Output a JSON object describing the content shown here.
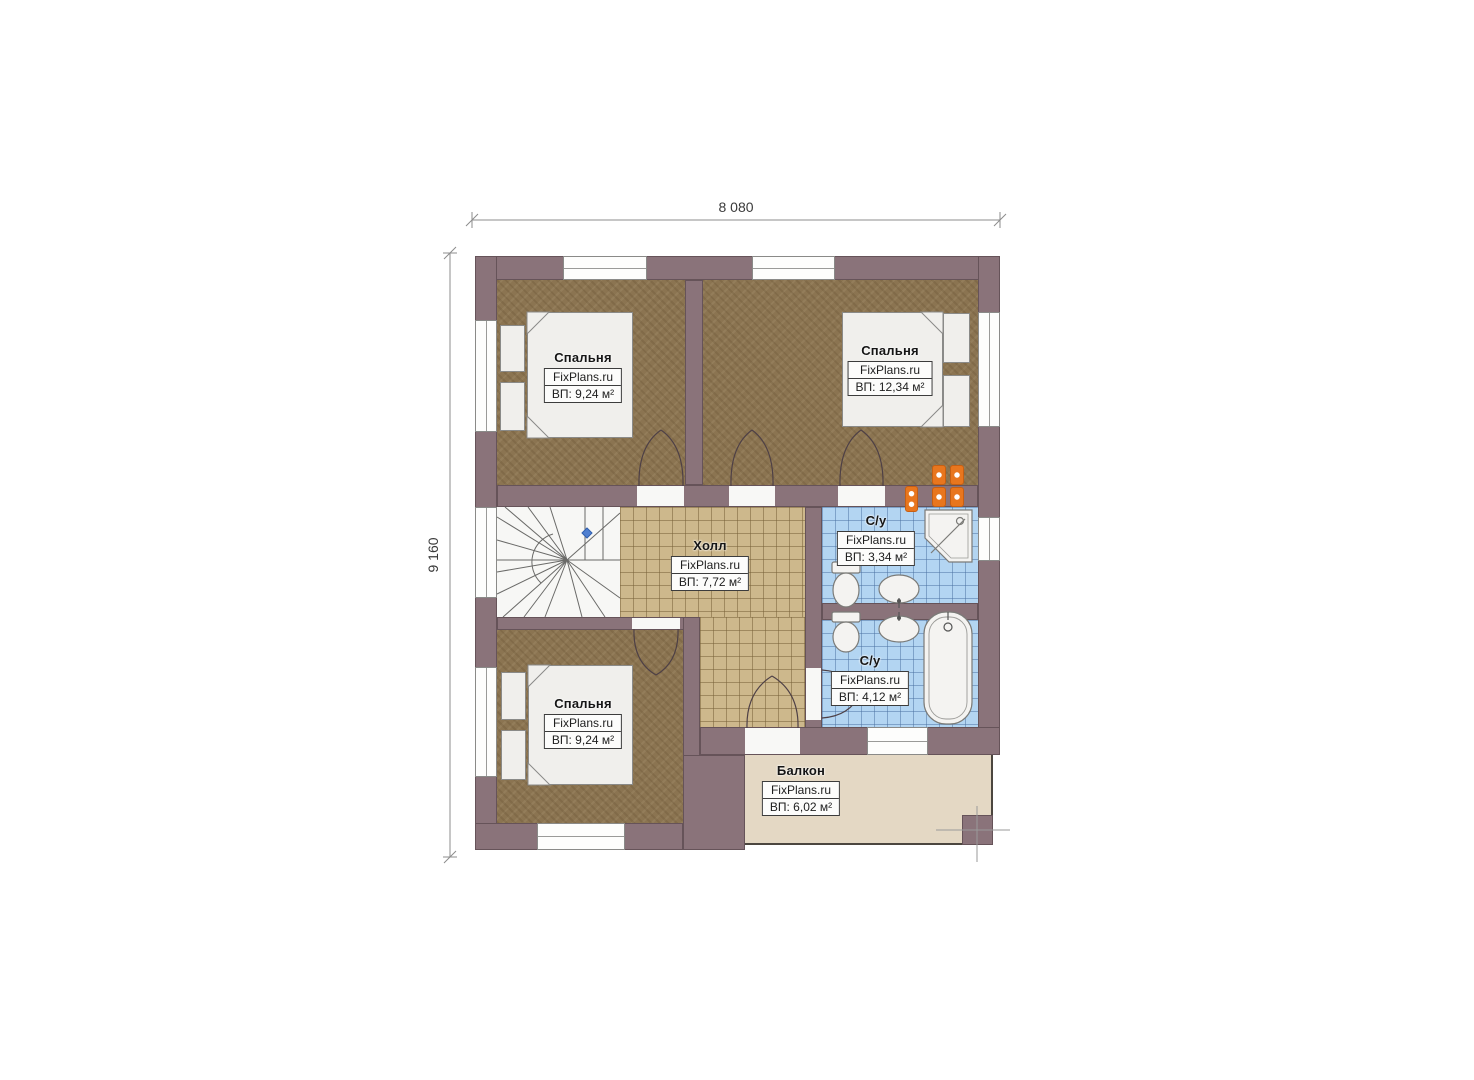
{
  "watermark": "FixPlans.ru",
  "dimensions": {
    "top": "8 080",
    "left": "9 160"
  },
  "rooms": {
    "bedroom_top_left": {
      "name": "Спальня",
      "area": "ВП: 9,24 м²"
    },
    "bedroom_top_right": {
      "name": "Спальня",
      "area": "ВП: 12,34 м²"
    },
    "hall": {
      "name": "Холл",
      "area": "ВП: 7,72 м²"
    },
    "bathroom_upper": {
      "name": "С/у",
      "area": "ВП: 3,34 м²"
    },
    "bathroom_lower": {
      "name": "С/у",
      "area": "ВП: 4,12 м²"
    },
    "bedroom_bottom_left": {
      "name": "Спальня",
      "area": "ВП: 9,24 м²"
    },
    "balcony": {
      "name": "Балкон",
      "area": "ВП: 6,02 м²"
    }
  },
  "colors": {
    "wall": "#8a737a",
    "bedroom_floor": "#8b7451",
    "hall_floor": "#cdb88c",
    "bathroom_floor": "#b3d5f2",
    "balcony_floor": "#e4d8c4",
    "stairs_floor": "#f7f7f5",
    "fixture_white": "#f0efec",
    "socket_orange": "#e8761e",
    "marker_blue": "#4f7fd0"
  }
}
